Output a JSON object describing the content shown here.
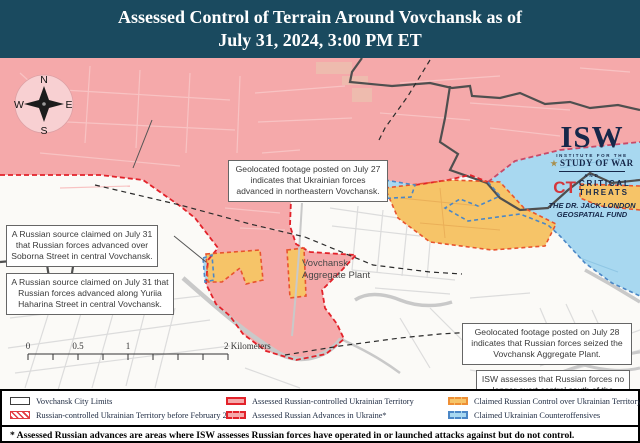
{
  "header": {
    "line1": "Assessed Control of Terrain Around Vovchansk as of",
    "line2": "July 31, 2024, 3:00 PM ET"
  },
  "logo": {
    "wordmark": "ISW",
    "star": "★",
    "institute": "INSTITUTE FOR THE",
    "study": "STUDY OF WAR",
    "and": "AND",
    "ct": "CT",
    "critical": "CRITICAL",
    "threats": "THREATS",
    "fund1": "THE DR. JACK LONDON",
    "fund2": "GEOSPATIAL FUND"
  },
  "compass": {
    "n": "N",
    "e": "E",
    "s": "S",
    "w": "W"
  },
  "callouts": [
    {
      "text": "Geolocated footage posted on July 27 indicates that Ukrainian forces advanced in northeastern Vovchansk."
    },
    {
      "text": "A Russian source claimed on July 31 that Russian forces advanced over Soborna Street in central Vovchansk."
    },
    {
      "text": "A Russian source claimed on July 31 that Russian forces advanced along Yuriia Haharina Street in central Vovchansk."
    },
    {
      "text": "Geolocated footage posted on July 28 indicates that Russian forces seized the Vovchansk Aggregate Plant."
    },
    {
      "text": "ISW assesses that Russian forces no longer exert control south of the Vovcha River in Vovchansk."
    }
  ],
  "map_labels": {
    "plant1": "Vovchansk",
    "plant2": "Aggregate Plant"
  },
  "scale": {
    "t0": "0",
    "t05": "0.5",
    "t1": "1",
    "t2": "2 Kilometers"
  },
  "attribution": {
    "line1": "Map by George Barros, Kateryna Stepanenko, Noel Mikkelsen, Daniel Mealie, Thomas Bergeron, Mitchell Belcher, Tom Thacker, Benjamin Cordola, and Harrison Hurwitz",
    "line2": "© 2024 Institute for the Study of War and AEI's Critical Threats Project"
  },
  "legend": {
    "items": [
      {
        "label": "Vovchansk City Limits"
      },
      {
        "label": "Russian-controlled Ukrainian Territory before February 24"
      },
      {
        "label": "Assessed Russian-controlled Ukrainian Territory"
      },
      {
        "label": "Assessed Russian Advances in Ukraine*"
      },
      {
        "label": "Claimed Russian Control over Ukrainian Territory"
      },
      {
        "label": "Claimed Ukrainian Counteroffensives"
      }
    ]
  },
  "footnote": "* Assessed Russian advances are areas where ISW assesses Russian forces have operated in or launched attacks against but do not control.",
  "colors": {
    "header_bg": "#1a4a5f",
    "assessed_russian_controlled": "#f5a9aa",
    "russian_border_red": "#e2222a",
    "claimed_russian_control": "#f6c468",
    "claimed_russian_border": "#ee8f35",
    "claimed_ukrainian_counteroffensive": "#a8d8f0",
    "ukrainian_border_blue": "#4b87c6",
    "city_limits_line": "#4f4f4f"
  }
}
